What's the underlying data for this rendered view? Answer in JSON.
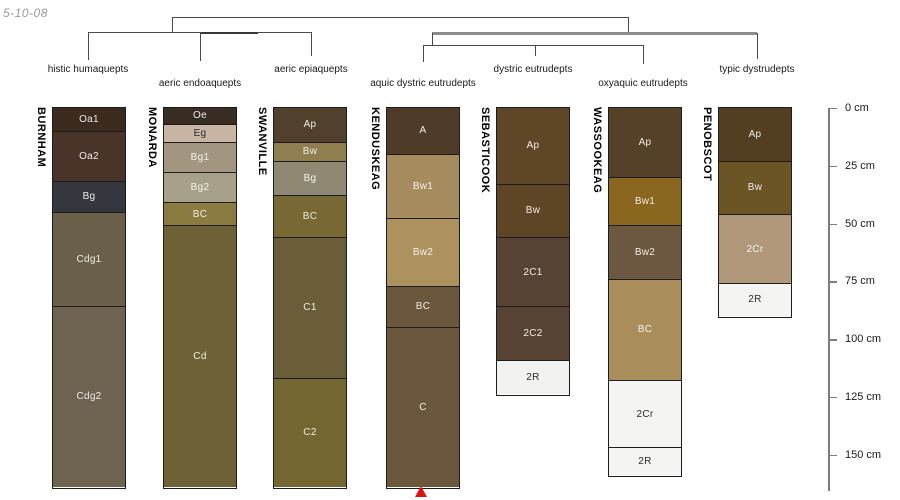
{
  "meta": {
    "date_stamp": "5-10-08"
  },
  "chart_data": {
    "type": "soil-profile-dendrogram",
    "description": "Dendrogram of soil taxonomic groups above soil profile sketches with horizon designations and a depth scale",
    "depth_unit": "cm",
    "px_per_cm": 2.312,
    "surface_px": 108,
    "depth_axis": {
      "x": 828,
      "bottom_px": 491,
      "tick_length": 9,
      "ticks_cm": [
        0,
        25,
        50,
        75,
        100,
        125,
        150
      ],
      "tick_label_suffix": " cm"
    },
    "dendrogram": {
      "groups": [
        {
          "label": "histic humaquepts",
          "x": 88,
          "y": 64
        },
        {
          "label": "aeric endoaquepts",
          "x": 200,
          "y": 78
        },
        {
          "label": "aeric epiaquepts",
          "x": 311,
          "y": 64
        },
        {
          "label": "aquic dystric eutrudepts",
          "x": 423,
          "y": 78
        },
        {
          "label": "dystric eutrudepts",
          "x": 533,
          "y": 64
        },
        {
          "label": "oxyaquic eutrudepts",
          "x": 643,
          "y": 78
        },
        {
          "label": "typic dystrudepts",
          "x": 757,
          "y": 64
        }
      ],
      "segments": [
        {
          "x1": 172,
          "y1": 17,
          "x2": 628,
          "y2": 17
        },
        {
          "x1": 172,
          "y1": 17,
          "x2": 172,
          "y2": 32
        },
        {
          "x1": 88,
          "y1": 32,
          "x2": 311,
          "y2": 32
        },
        {
          "x1": 200,
          "y1": 31.5,
          "x2": 258,
          "y2": 31.5,
          "w": 2,
          "color": "#383838"
        },
        {
          "x1": 88,
          "y1": 32,
          "x2": 88,
          "y2": 60
        },
        {
          "x1": 200,
          "y1": 32,
          "x2": 200,
          "y2": 61
        },
        {
          "x1": 311,
          "y1": 32,
          "x2": 311,
          "y2": 56
        },
        {
          "x1": 628,
          "y1": 17,
          "x2": 628,
          "y2": 33
        },
        {
          "x1": 432,
          "y1": 32,
          "x2": 757,
          "y2": 32,
          "w": 2.5,
          "color": "#8c8c8c"
        },
        {
          "x1": 757,
          "y1": 33,
          "x2": 757,
          "y2": 59
        },
        {
          "x1": 432,
          "y1": 33,
          "x2": 432,
          "y2": 45
        },
        {
          "x1": 423,
          "y1": 45,
          "x2": 643,
          "y2": 45
        },
        {
          "x1": 423,
          "y1": 45,
          "x2": 423,
          "y2": 62
        },
        {
          "x1": 535,
          "y1": 45,
          "x2": 535,
          "y2": 56
        },
        {
          "x1": 643,
          "y1": 45,
          "x2": 643,
          "y2": 64
        }
      ]
    },
    "profiles": [
      {
        "name": "BURNHAM",
        "taxon": "histic humaquepts",
        "x": 52,
        "width": 74,
        "horizons": [
          {
            "name": "Oa1",
            "top_cm": 0,
            "bottom_cm": 10,
            "color": "#3B2B1F",
            "text": "#EFECE6"
          },
          {
            "name": "Oa2",
            "top_cm": 10,
            "bottom_cm": 32,
            "color": "#4A342A",
            "text": "#EFECE6"
          },
          {
            "name": "Bg",
            "top_cm": 32,
            "bottom_cm": 45,
            "color": "#34373D",
            "text": "#EFECE6"
          },
          {
            "name": "Cdg1",
            "top_cm": 45,
            "bottom_cm": 86,
            "color": "#6A6049",
            "text": "#EFECE6"
          },
          {
            "name": "Cdg2",
            "top_cm": 86,
            "bottom_cm": 164,
            "color": "#6D6350",
            "text": "#EFECE6"
          }
        ]
      },
      {
        "name": "MONARDA",
        "taxon": "aeric endoaquepts",
        "x": 163,
        "width": 74,
        "horizons": [
          {
            "name": "Oe",
            "top_cm": 0,
            "bottom_cm": 7,
            "color": "#382D23",
            "text": "#EFECE6"
          },
          {
            "name": "Eg",
            "top_cm": 7,
            "bottom_cm": 15,
            "color": "#C9B5A3",
            "text": "#2b2b2b"
          },
          {
            "name": "Bg1",
            "top_cm": 15,
            "bottom_cm": 28,
            "color": "#A29681",
            "text": "#F4F2EE"
          },
          {
            "name": "Bg2",
            "top_cm": 28,
            "bottom_cm": 41,
            "color": "#A8A18A",
            "text": "#F4F2EE"
          },
          {
            "name": "BC",
            "top_cm": 41,
            "bottom_cm": 51,
            "color": "#8B7B41",
            "text": "#EFECE6"
          },
          {
            "name": "Cd",
            "top_cm": 51,
            "bottom_cm": 164,
            "color": "#6E6136",
            "text": "#EFECE6"
          }
        ]
      },
      {
        "name": "SWANVILLE",
        "taxon": "aeric epiaquepts",
        "x": 273,
        "width": 74,
        "horizons": [
          {
            "name": "Ap",
            "top_cm": 0,
            "bottom_cm": 15,
            "color": "#51402B",
            "text": "#EFECE6"
          },
          {
            "name": "Bw",
            "top_cm": 15,
            "bottom_cm": 23,
            "color": "#8F7E50",
            "text": "#EFECE6"
          },
          {
            "name": "Bg",
            "top_cm": 23,
            "bottom_cm": 38,
            "color": "#8F8973",
            "text": "#F4F2EE"
          },
          {
            "name": "BC",
            "top_cm": 38,
            "bottom_cm": 56,
            "color": "#776834",
            "text": "#EFECE6"
          },
          {
            "name": "C1",
            "top_cm": 56,
            "bottom_cm": 117,
            "color": "#6A5E3A",
            "text": "#EFECE6"
          },
          {
            "name": "C2",
            "top_cm": 117,
            "bottom_cm": 164,
            "color": "#746631",
            "text": "#EFECE6"
          }
        ]
      },
      {
        "name": "KENDUSKEAG",
        "taxon": "aquic dystric eutrudepts",
        "x": 386,
        "width": 74,
        "horizons": [
          {
            "name": "A",
            "top_cm": 0,
            "bottom_cm": 20,
            "color": "#4E3C29",
            "text": "#EFECE6"
          },
          {
            "name": "Bw1",
            "top_cm": 20,
            "bottom_cm": 48,
            "color": "#A58B5E",
            "text": "#F4F2EE"
          },
          {
            "name": "Bw2",
            "top_cm": 48,
            "bottom_cm": 77,
            "color": "#AD9260",
            "text": "#F4F2EE"
          },
          {
            "name": "BC",
            "top_cm": 77,
            "bottom_cm": 95,
            "color": "#6B573B",
            "text": "#EFECE6"
          },
          {
            "name": "C",
            "top_cm": 95,
            "bottom_cm": 164,
            "color": "#6A573C",
            "text": "#EFECE6"
          }
        ]
      },
      {
        "name": "SEBASTICOOK",
        "taxon": "dystric eutrudepts",
        "x": 496,
        "width": 74,
        "horizons": [
          {
            "name": "Ap",
            "top_cm": 0,
            "bottom_cm": 33,
            "color": "#5F4627",
            "text": "#EFECE6"
          },
          {
            "name": "Bw",
            "top_cm": 33,
            "bottom_cm": 56,
            "color": "#5D4526",
            "text": "#EFECE6"
          },
          {
            "name": "2C1",
            "top_cm": 56,
            "bottom_cm": 86,
            "color": "#574333",
            "text": "#EFECE6"
          },
          {
            "name": "2C2",
            "top_cm": 86,
            "bottom_cm": 109,
            "color": "#574333",
            "text": "#EFECE6"
          },
          {
            "name": "2R",
            "top_cm": 109,
            "bottom_cm": 124,
            "color": "#F2F2F0",
            "text": "#2b2b2b"
          }
        ]
      },
      {
        "name": "WASSOOKEAG",
        "taxon": "oxyaquic eutrudepts",
        "x": 608,
        "width": 74,
        "horizons": [
          {
            "name": "Ap",
            "top_cm": 0,
            "bottom_cm": 30,
            "color": "#544128",
            "text": "#EFECE6"
          },
          {
            "name": "Bw1",
            "top_cm": 30,
            "bottom_cm": 51,
            "color": "#8A661E",
            "text": "#EFECE6"
          },
          {
            "name": "Bw2",
            "top_cm": 51,
            "bottom_cm": 74,
            "color": "#6C5740",
            "text": "#EFECE6"
          },
          {
            "name": "BC",
            "top_cm": 74,
            "bottom_cm": 118,
            "color": "#A98E5B",
            "text": "#F4F2EE"
          },
          {
            "name": "2Cr",
            "top_cm": 118,
            "bottom_cm": 147,
            "color": "#F4F4F3",
            "text": "#2b2b2b"
          },
          {
            "name": "2R",
            "top_cm": 147,
            "bottom_cm": 159,
            "color": "#F4F4F3",
            "text": "#2b2b2b"
          }
        ]
      },
      {
        "name": "PENOBSCOT",
        "taxon": "typic dystrudepts",
        "x": 718,
        "width": 74,
        "horizons": [
          {
            "name": "Ap",
            "top_cm": 0,
            "bottom_cm": 23,
            "color": "#543E22",
            "text": "#EFECE6"
          },
          {
            "name": "Bw",
            "top_cm": 23,
            "bottom_cm": 46,
            "color": "#6C5524",
            "text": "#EFECE6"
          },
          {
            "name": "2Cr",
            "top_cm": 46,
            "bottom_cm": 76,
            "color": "#B2987A",
            "text": "#F4F2EE"
          },
          {
            "name": "2R",
            "top_cm": 76,
            "bottom_cm": 90,
            "color": "#F4F4F3",
            "text": "#2b2b2b"
          }
        ]
      }
    ],
    "marker": {
      "shape": "triangle-up",
      "color": "#DE1212",
      "x": 421,
      "y": 486,
      "profile": "KENDUSKEAG"
    }
  }
}
